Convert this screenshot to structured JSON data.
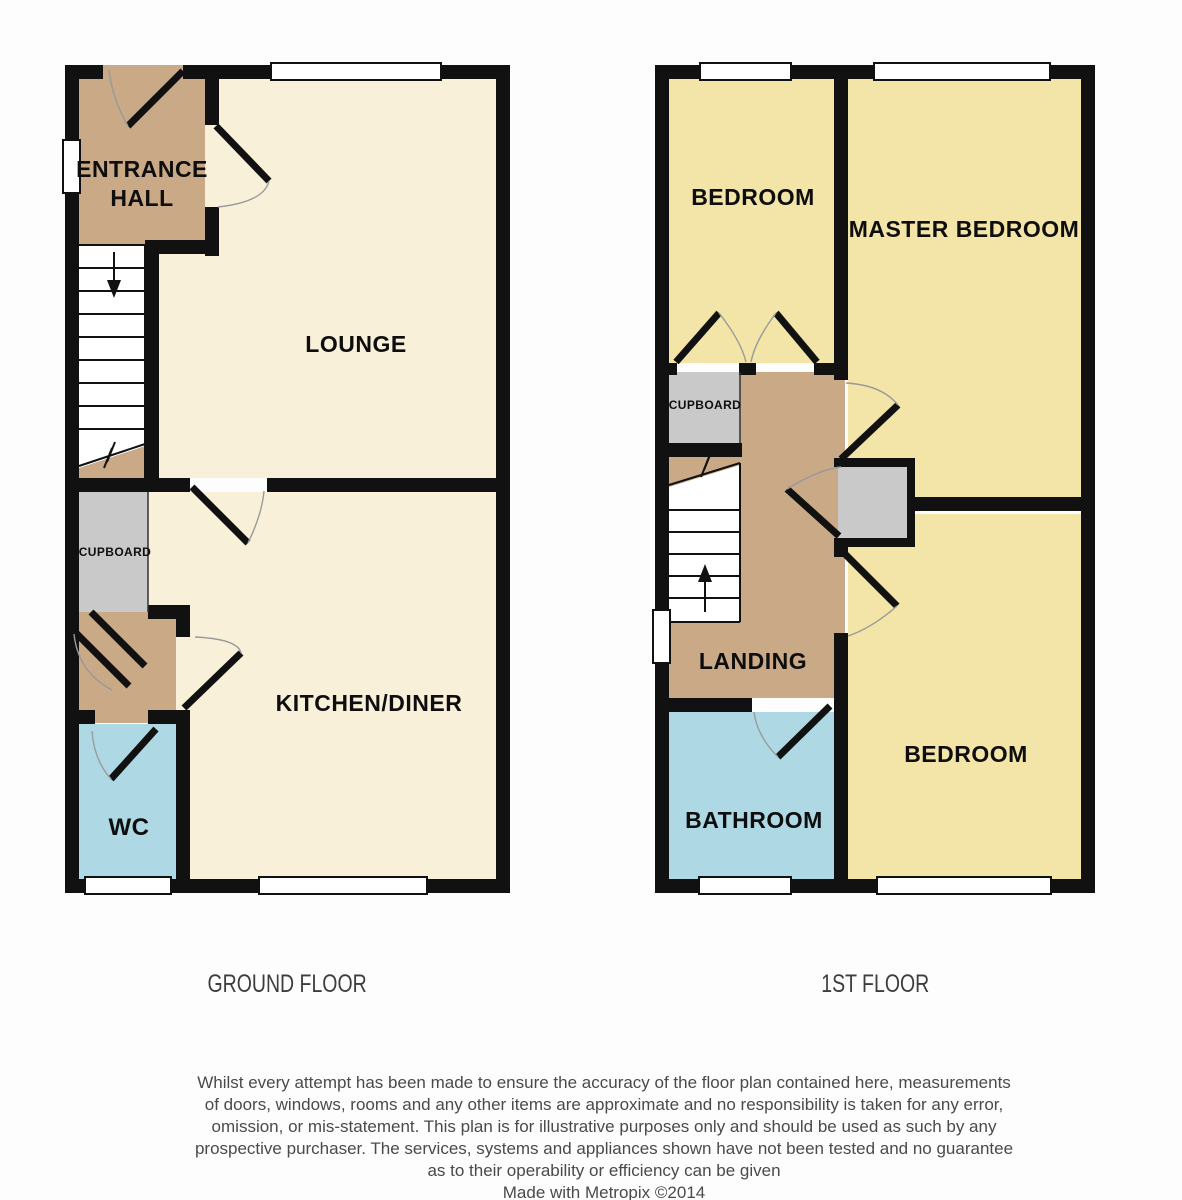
{
  "ground_floor": {
    "caption": "GROUND FLOOR",
    "rooms": {
      "entrance_hall_line1": "ENTRANCE",
      "entrance_hall_line2": "HALL",
      "lounge": "LOUNGE",
      "cupboard": "CUPBOARD",
      "kitchen_diner": "KITCHEN/DINER",
      "wc": "WC"
    }
  },
  "first_floor": {
    "caption": "1ST FLOOR",
    "rooms": {
      "bedroom_front": "BEDROOM",
      "master_bedroom": "MASTER BEDROOM",
      "cupboard": "CUPBOARD",
      "landing": "LANDING",
      "bathroom": "BATHROOM",
      "bedroom_back": "BEDROOM"
    }
  },
  "disclaimer": {
    "lines": [
      "Whilst every attempt has been made to ensure the accuracy of the floor plan contained here, measurements",
      "of doors, windows, rooms and any other items are approximate and no responsibility is taken for any error,",
      "omission, or mis-statement. This plan is for illustrative purposes only and should be used as such by any",
      "prospective purchaser. The services, systems and appliances shown have not been tested and no guarantee",
      "as to their operability or efficiency can be given"
    ],
    "credit": "Made with Metropix ©2014"
  },
  "colors": {
    "room_cream": "#f8f0d8",
    "room_yellow": "#f2e5a7",
    "hall_brown": "#c9a986",
    "wet_room_blue": "#aed9e4",
    "cupboard_grey": "#c9c9c9",
    "stairs_white": "#ffffff",
    "wall_black": "#111111",
    "caption_grey": "#3d3d3d",
    "disclaimer_grey": "#4a4a4a"
  }
}
